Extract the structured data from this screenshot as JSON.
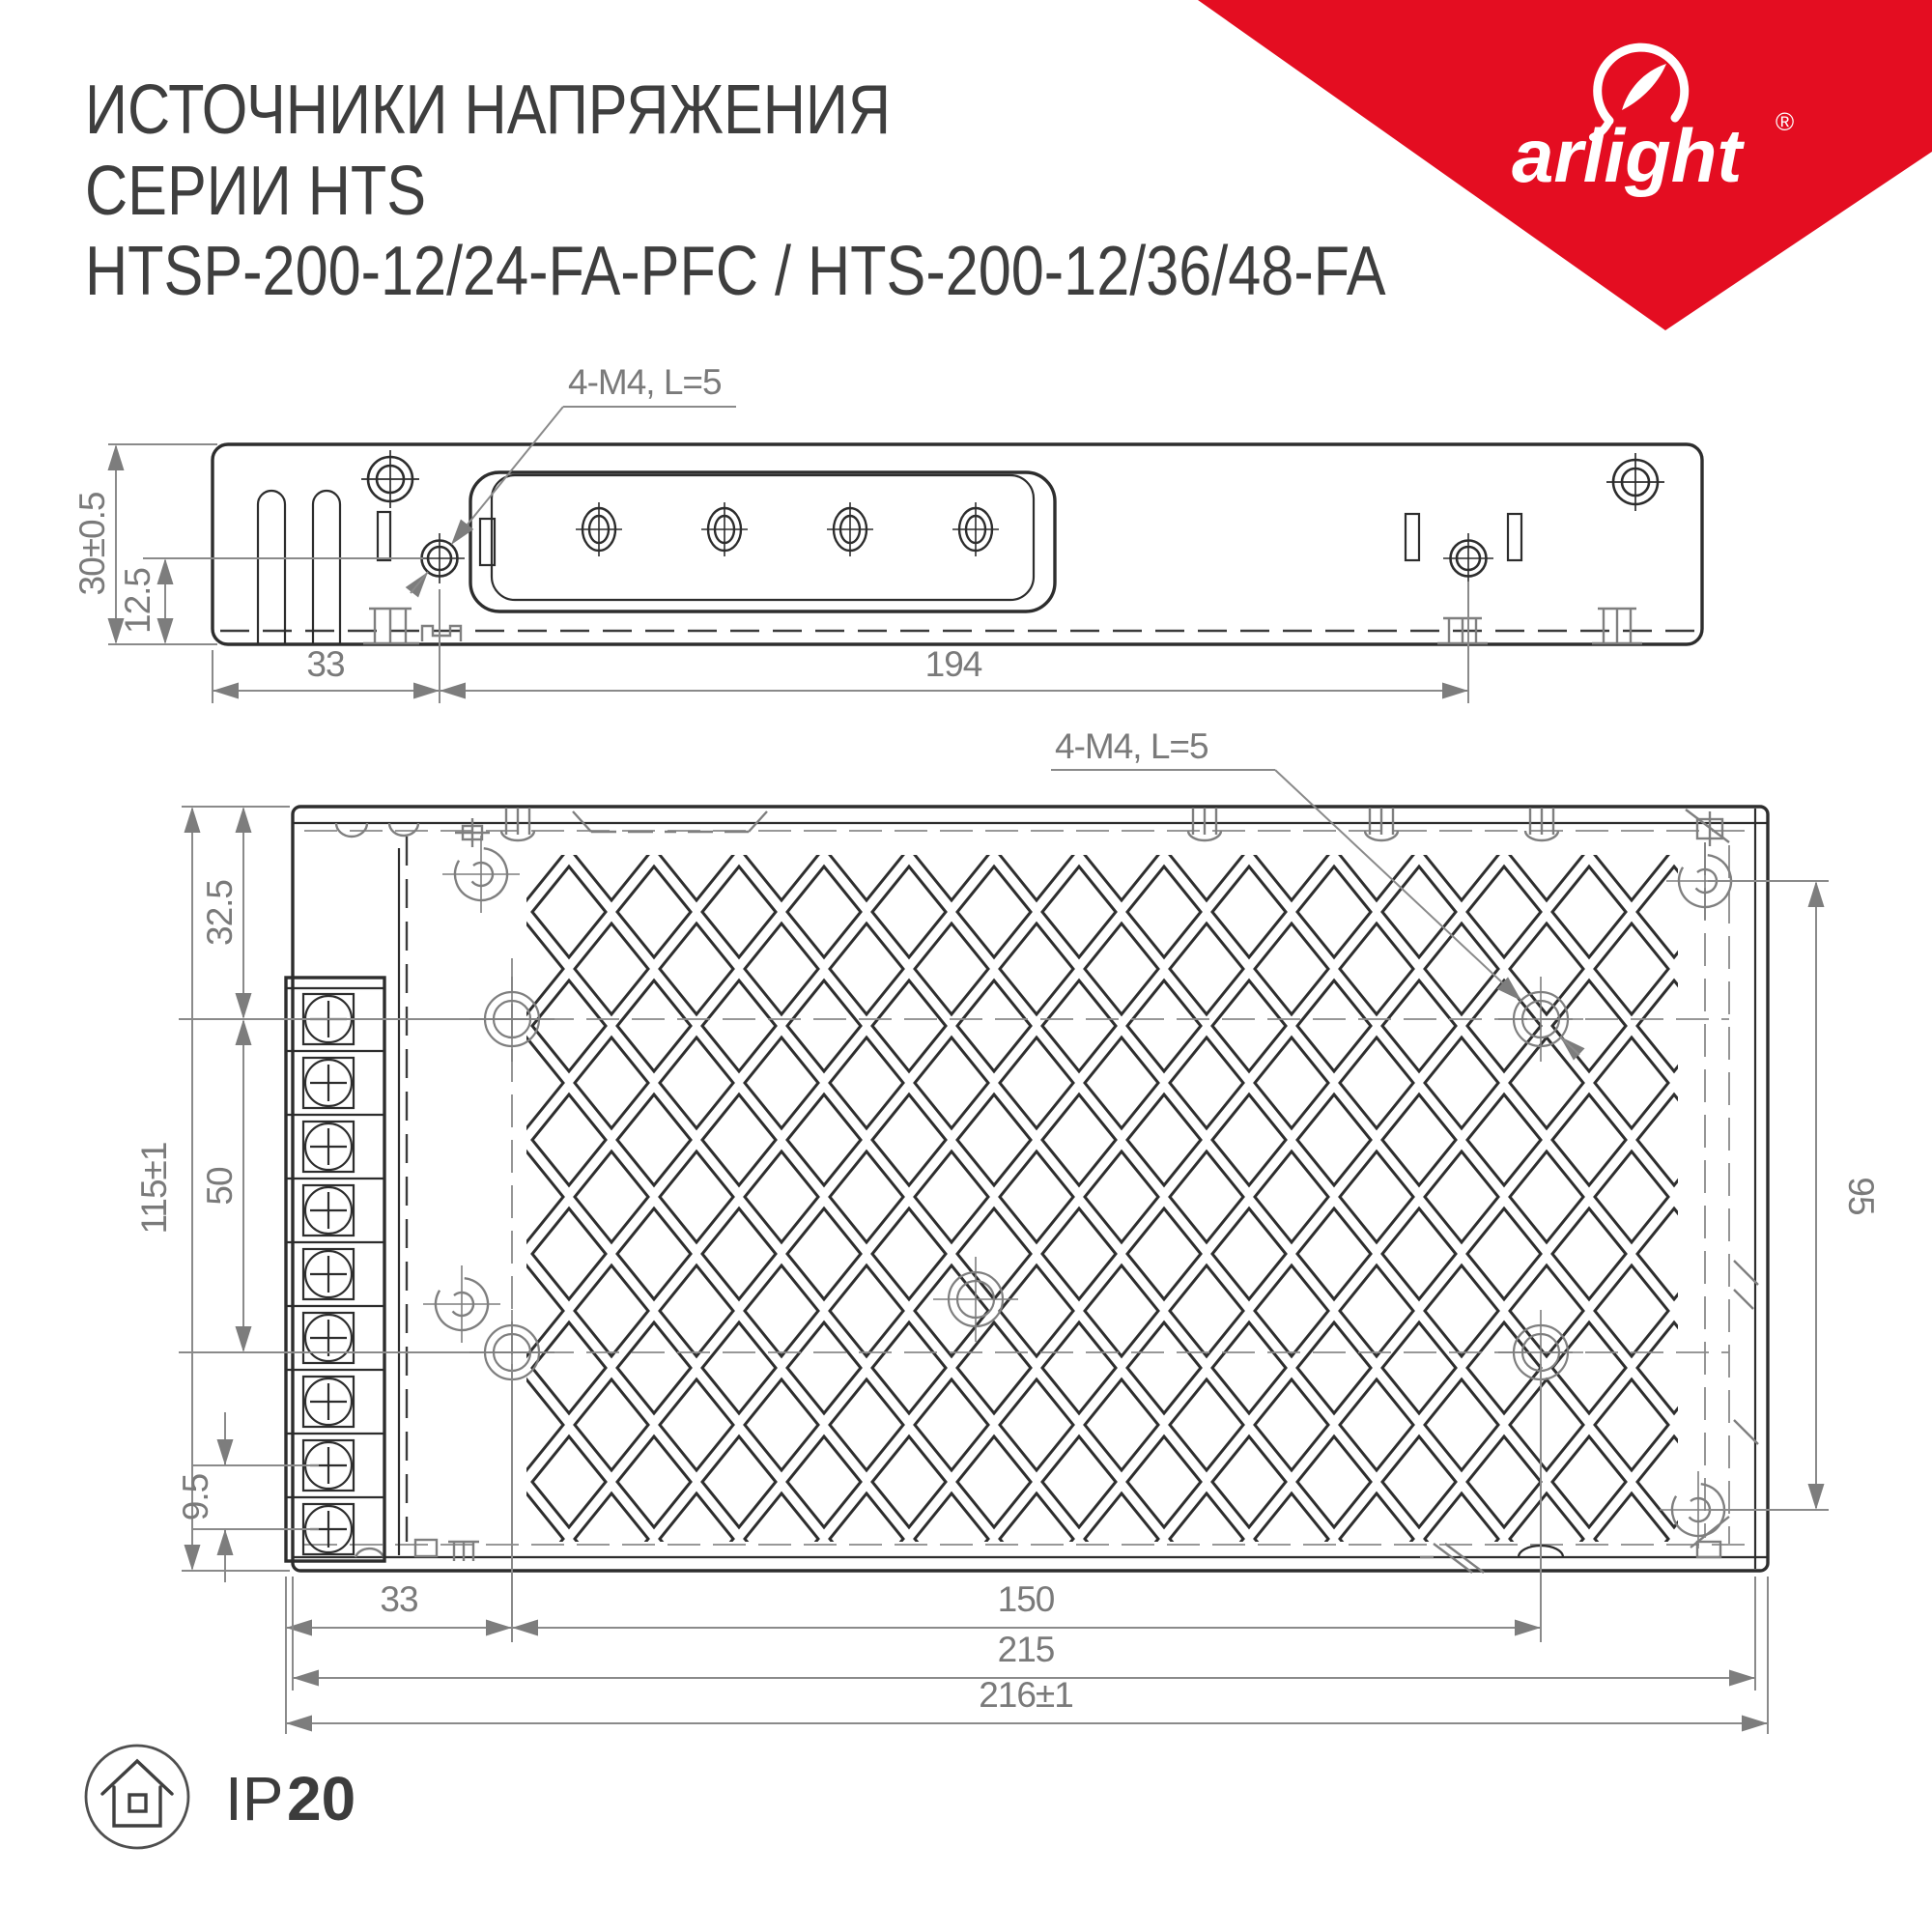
{
  "header": {
    "title_lines": [
      "ИСТОЧНИКИ НАПРЯЖЕНИЯ",
      "СЕРИИ HTS",
      "HTSP-200-12/24-FA-PFC / HTS-200-12/36/48-FA"
    ]
  },
  "brand": {
    "wordmark": "arlight",
    "registered": "®",
    "banner_color": "#e40d21"
  },
  "side_view": {
    "hole_label": "4-M4, L=5",
    "height": "30±0.5",
    "hole_offset": "12.5",
    "left_span": "33",
    "hole_span": "194"
  },
  "top_view": {
    "hole_label": "4-M4, L=5",
    "top_offset": "32.5",
    "height": "115±1",
    "row_span": "50",
    "terminal_pitch": "9.5",
    "right_span": "95",
    "left_span": "33",
    "hole_span": "150",
    "inner_width": "215",
    "outer_width": "216±1"
  },
  "footer": {
    "ip_prefix": "IP",
    "ip_value": "20"
  }
}
